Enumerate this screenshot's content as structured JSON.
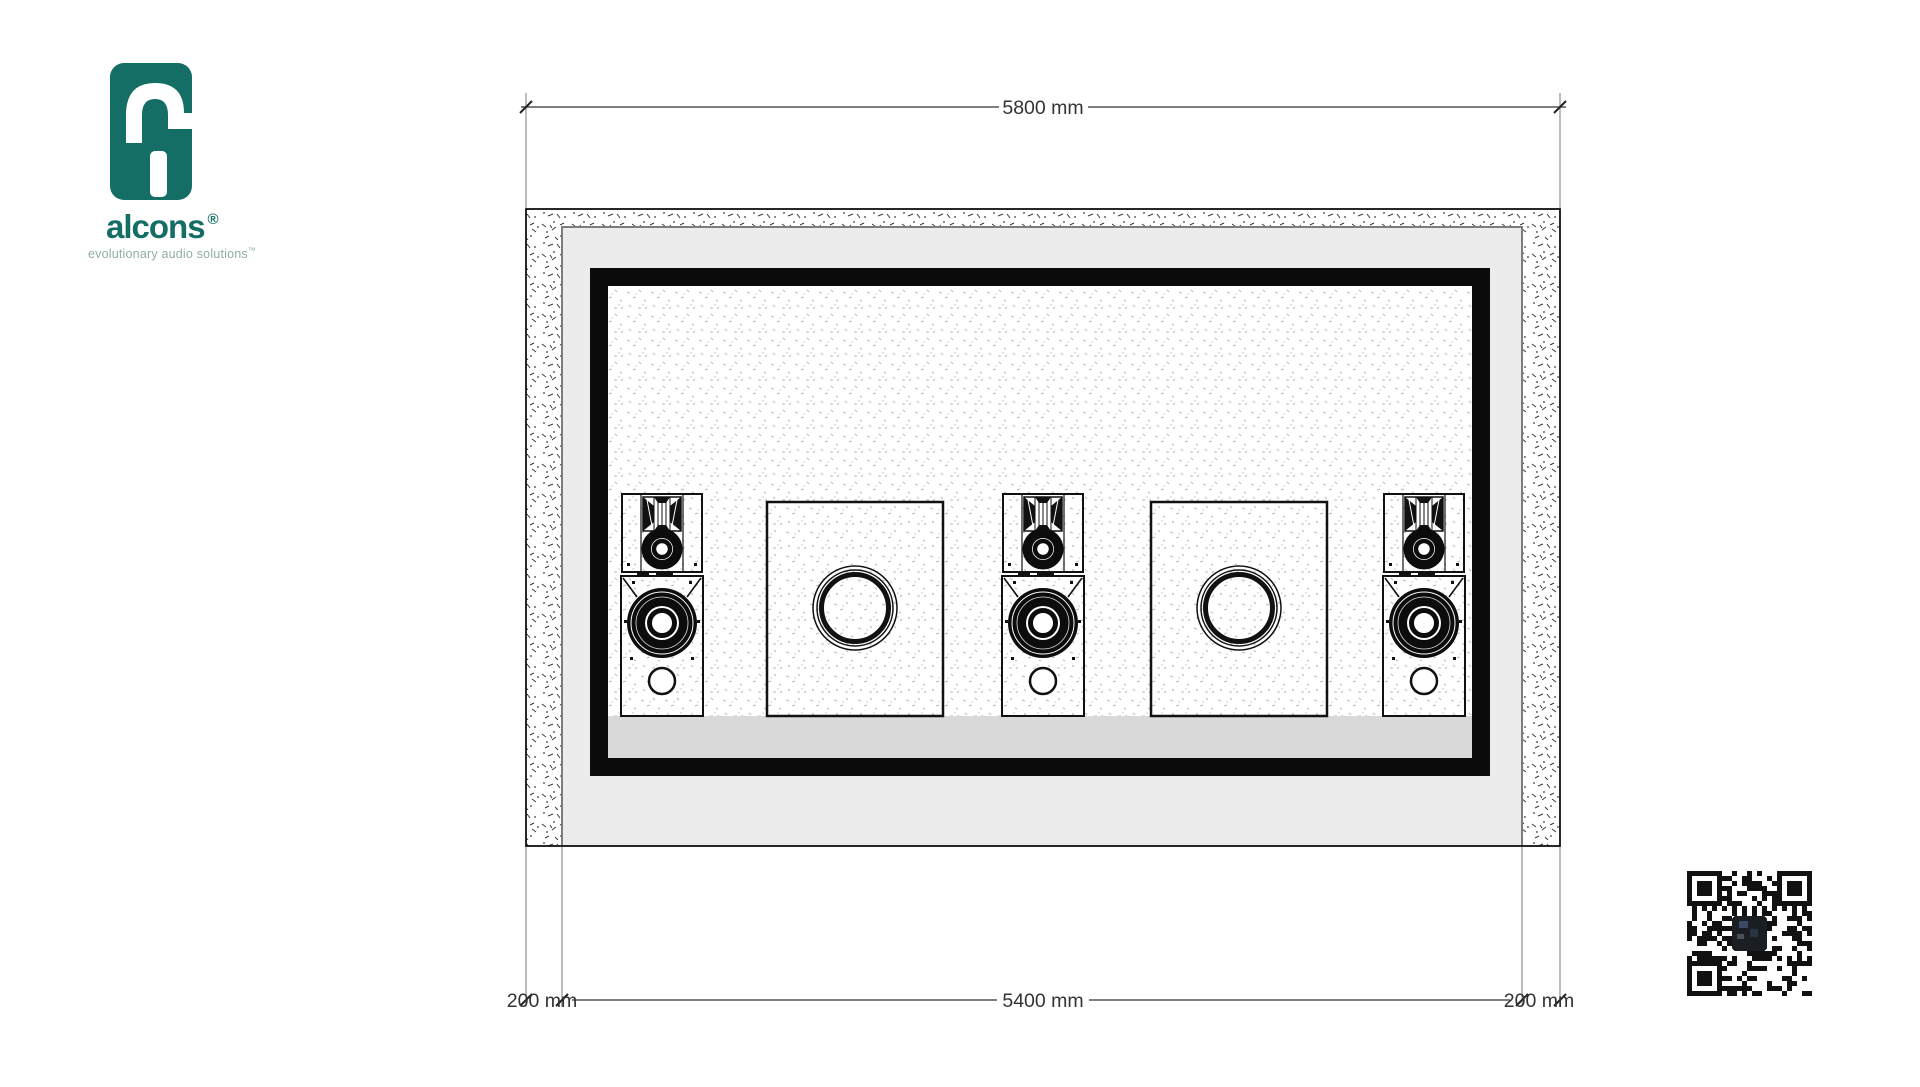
{
  "logo": {
    "brand": "alcons",
    "registered_mark": "®",
    "tagline": "evolutionary audio solutions",
    "trademark_mark": "™",
    "brand_color": "#146e65"
  },
  "drawing": {
    "dimensions": {
      "top_overall": "5800 mm",
      "bottom_left_wall": "200 mm",
      "bottom_inner": "5400 mm",
      "bottom_right_wall": "200 mm"
    },
    "content": {
      "speaker_stacks": 3,
      "subwoofer_cabinets": 2
    }
  }
}
